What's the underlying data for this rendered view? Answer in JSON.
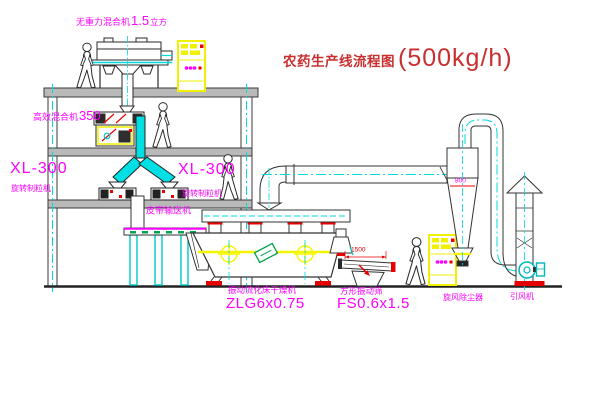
{
  "title": {
    "text": "农药生产线流程图",
    "capacity": "(500kg/h)"
  },
  "labels": {
    "gravity_free_mixer": {
      "name": "无重力混合机",
      "value": "1.5",
      "unit": "立方"
    },
    "high_efficiency_mixer": {
      "name": "高效混合机",
      "value": "350"
    },
    "granulator_left": {
      "model": "XL-300",
      "name": "旋转制粒机"
    },
    "granulator_right": {
      "model": "XL-300",
      "name": "旋转制粒机"
    },
    "belt_conveyor": "皮带输送机",
    "fluid_bed_dryer": {
      "name": "振动流化床干燥机",
      "model": "ZLG6x0.75"
    },
    "vibrating_screen": {
      "name": "方形振动筛",
      "model": "FS0.6x1.5"
    },
    "cyclone": "旋风除尘器",
    "induced_fan": "引风机"
  },
  "dimensions": {
    "screen_length": "1500",
    "cyclone_diameter": "800"
  },
  "colors": {
    "label_magenta": "#ff00ff",
    "title_red": "#c92f2f",
    "dimension_red": "#e80000",
    "line_dark": "#2a2a2a",
    "duct_cyan": "#00dfe3",
    "centerline_cyan": "#00d9dd",
    "cabinet_yellow": "#f0f000",
    "highlight_yellow": "#f5f500",
    "detail_green": "#00a24a",
    "slab_gray": "#b9b9b9",
    "background": "#ffffff"
  }
}
